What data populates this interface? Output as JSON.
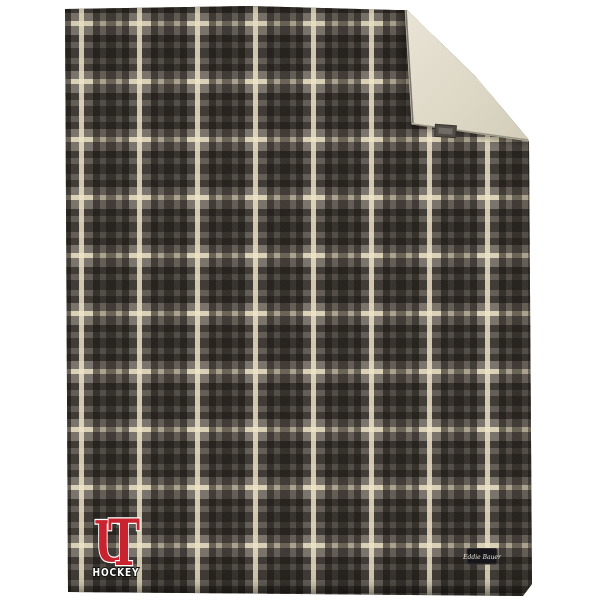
{
  "photo": {
    "description": "Gray tartan plaid fleece blanket, top-right corner folded over to reveal cream sherpa lining, embroidered team logo at lower left",
    "background_color": "#ffffff"
  },
  "blanket": {
    "plaid": {
      "base_color": "#7b746b",
      "dark_stripe_color": "#34302a",
      "cream_stripe_color": "#e7ddc0",
      "repeat_px": 58
    },
    "sherpa": {
      "color_light": "#e9e4d6",
      "color_dark": "#d2ccb9"
    }
  },
  "fold_tag": {
    "bg_color": "#504c46",
    "inner_color": "#716c64"
  },
  "brand_tag": {
    "label": "Eddie Bauer",
    "bg_color": "#17171b",
    "text_color": "#ece9dd"
  },
  "logo": {
    "monogram_u": "U",
    "monogram_t": "T",
    "word": "HOCKEY",
    "red": "#c8232e",
    "outline_color": "#ffffff",
    "word_color": "#ffffff",
    "word_outline_color": "#14120e"
  }
}
